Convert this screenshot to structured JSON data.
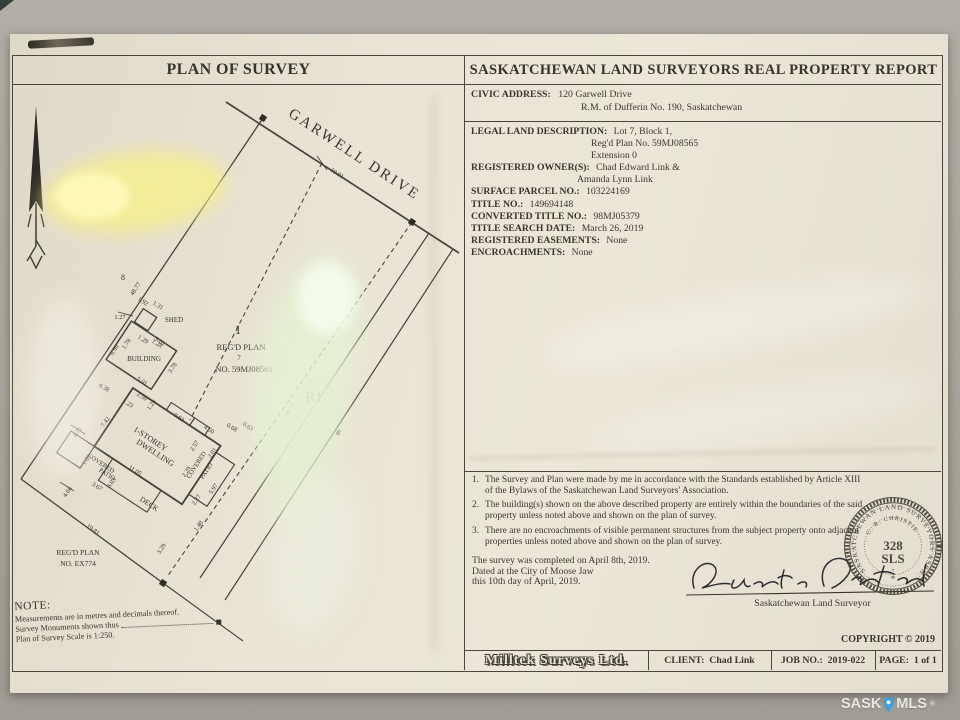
{
  "colors": {
    "paper": "#e9e4d5",
    "ink": "#3a362f",
    "background": "#aca89f",
    "watermark_pin": "#3e9fd9"
  },
  "header": {
    "plan_title": "PLAN OF SURVEY",
    "report_title": "SASKATCHEWAN LAND SURVEYORS REAL PROPERTY REPORT"
  },
  "civic": {
    "label": "CIVIC ADDRESS:",
    "address_line1": "120 Garwell Drive",
    "address_line2": "R.M. of Dufferin No. 190, Saskatchewan"
  },
  "legal": {
    "description_label": "LEGAL LAND DESCRIPTION:",
    "description_line1": "Lot 7, Block 1,",
    "description_line2": "Reg'd Plan No. 59MJ08565",
    "description_line3": "Extension 0",
    "owners_label": "REGISTERED OWNER(S):",
    "owners_line1": "Chad Edward Link &",
    "owners_line2": "Amanda Lynn Link",
    "surface_parcel_label": "SURFACE PARCEL NO.:",
    "surface_parcel_value": "103224169",
    "title_no_label": "TITLE NO.:",
    "title_no_value": "149694148",
    "converted_title_label": "CONVERTED TITLE NO.:",
    "converted_title_value": "98MJ05379",
    "title_search_label": "TITLE SEARCH DATE:",
    "title_search_value": "March 26, 2019",
    "easements_label": "REGISTERED EASEMENTS:",
    "easements_value": "None",
    "encroachments_label": "ENCROACHMENTS:",
    "encroachments_value": "None"
  },
  "plan": {
    "street_name": "GARWELL DRIVE",
    "zone_label": "R1",
    "adjacent_lot": "6",
    "neighbour_lot": "8",
    "block_number": "1",
    "block_line1": "REG'D PLAN",
    "block_lot": "7",
    "block_line2": "NO. 59MJ08565",
    "south_plan_line1": "REG'D PLAN",
    "south_plan_line2": "NO. EX774",
    "buildings": {
      "shed": "SHED",
      "building": "BUILDING",
      "dwelling_line1": "1-STOREY",
      "dwelling_line2": "DWELLING",
      "deck": "DECK",
      "patio_line1": "COVERED",
      "patio_line2": "PATIO"
    },
    "measurements": {
      "frontage": "19.81",
      "side_left": "48.77",
      "side_right": "48.77",
      "rear": "19.81",
      "m_127": "1.27",
      "m_192": "1.92",
      "m_131": "1.31",
      "m_129": "1.29",
      "m_128": "1.28",
      "m_501a": "5.01",
      "m_501b": "5.01",
      "m_378": "3.78",
      "m_178": "1.78",
      "m_090": "0.90",
      "m_438": "4.38",
      "m_123": "1.23",
      "m_250": "2.50",
      "m_125": "1.25",
      "m_063a": "0.63",
      "m_450": "4.50",
      "m_068": "0.68",
      "m_063b": "0.63",
      "m_742": "7.42",
      "m_471": "4.71",
      "m_103": "1.03",
      "m_367": "3.67",
      "m_303": "3.03",
      "m_466": "4.66",
      "m_1105": "11.05",
      "m_229": "2.29",
      "m_257": "2.57",
      "m_201": "2.01",
      "m_597": "5.97",
      "m_227": "2.27",
      "m_140": "1.40",
      "m_329": "3.29"
    }
  },
  "notes_block": {
    "item1_num": "1.",
    "item1_text": "The Survey and Plan were made by me in accordance with the Standards established by Article XIII of the Bylaws of the Saskatchewan Land Surveyors' Association.",
    "item2_num": "2.",
    "item2_text": "The building(s) shown on the above described property are entirely within the boundaries of the said property unless noted above and shown on the plan of survey.",
    "item3_num": "3.",
    "item3_text": "There are no encroachments of visible permanent structures from the subject property onto adjacent properties unless noted above and shown on the plan of survey."
  },
  "completion": {
    "line1": "The survey was completed on April 8th, 2019.",
    "line2": "Dated at the City of Moose Jaw",
    "line3": "this 10th day of April, 2019."
  },
  "signature": {
    "title": "Saskatchewan Land Surveyor"
  },
  "seal": {
    "ring_text": "SASKATCHEWAN LAND SURVEYORS ASSN.",
    "name": "C. R. CHRISTIE",
    "number": "328",
    "letters": "SLS",
    "dot": "•",
    "star": "*"
  },
  "copyright": "COPYRIGHT © 2019",
  "footer": {
    "company": "Milltek Surveys Ltd.",
    "client": "CLIENT:  Chad Link",
    "job": "JOB NO.:  2019-022",
    "page": "PAGE:  1 of 1"
  },
  "note": {
    "title": "NOTE:",
    "line1": "Measurements are in metres and decimals thereof.",
    "line2": "Survey Monuments shown thus",
    "line3": "Plan of Survey Scale is 1:250."
  },
  "watermark": {
    "text1": "SASK",
    "text2": "MLS",
    "reg": "®"
  }
}
